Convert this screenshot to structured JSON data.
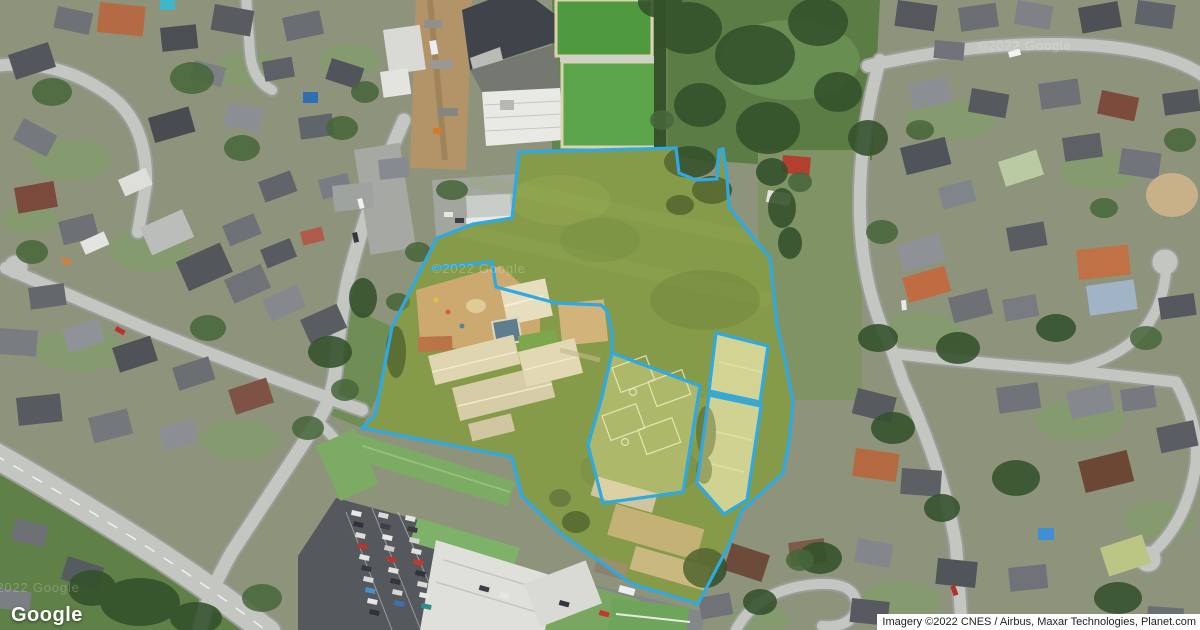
{
  "map_attribution": {
    "logo": "Google",
    "imagery_credit": "Imagery ©2022 CNES / Airbus, Maxar Technologies, Planet.com",
    "watermark": "©2022 Google"
  },
  "overlay": {
    "boundary_color": "#2fa9e2",
    "highlight_fill": "#ffd84d",
    "sub_highlight_fill": "#fff2a8"
  }
}
